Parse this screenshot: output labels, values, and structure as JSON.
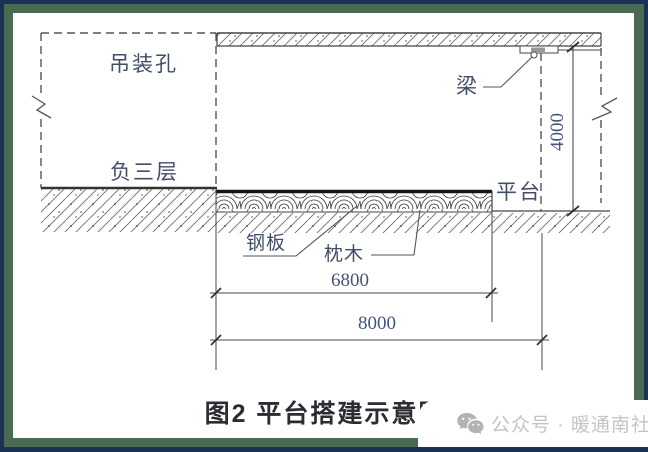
{
  "diagram": {
    "labels": {
      "hoisting_hole": "吊装孔",
      "basement_level": "负三层",
      "beam": "梁",
      "platform": "平台",
      "steel_plate": "钢板",
      "sleeper": "枕木"
    },
    "dimensions": {
      "height": "4000",
      "platform_length": "6800",
      "total_length": "8000"
    }
  },
  "caption": "图2  平台搭建示意图",
  "watermark": {
    "icon": "wechat-icon",
    "text": "公众号 · 暖通南社"
  },
  "colors": {
    "frame_outer": "#1b3156",
    "frame_inner": "#4a6b52",
    "line": "#4a4a4a",
    "steel_plate_line": "#151515",
    "label_text": "#424e66",
    "caption_text": "#2b2d33",
    "watermark_text": "#c4c4c4"
  }
}
